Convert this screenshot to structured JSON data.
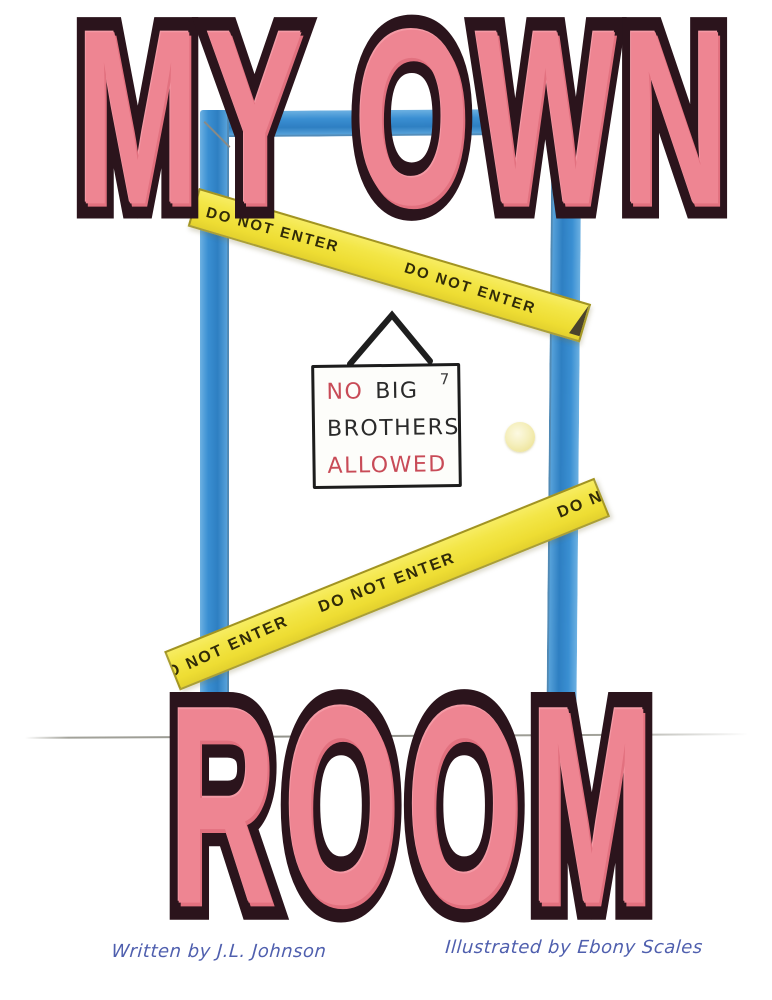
{
  "titles": {
    "top": "MY OWN",
    "bottom": "ROOM"
  },
  "sign": {
    "no": "NO",
    "big": "BIG",
    "line2": "BROTHERS",
    "line3": "ALLOWED",
    "corner_mark": "7"
  },
  "tape_upper": {
    "segments": [
      "DO NOT ENTER",
      "DO NOT ENTER"
    ]
  },
  "tape_lower": {
    "segments": [
      "O NOT ENTER",
      "DO NOT ENTER",
      "DO N"
    ]
  },
  "credits": {
    "written_by": "Written by J.L. Johnson",
    "illustrated_by": "Illustrated by Ebony Scales"
  },
  "colors": {
    "title_fill": "#ee8592",
    "title_outline": "#2b141c",
    "door_frame_blue": "#3a8fd2",
    "tape_yellow": "#f3e647",
    "tape_text": "#312b08",
    "sign_red": "#c84b57",
    "sign_black": "#2a2a2a",
    "credits_blue": "#4f5fae",
    "doorknob_yellow": "#f5efc0",
    "floor_gray": "#a3a39b"
  }
}
